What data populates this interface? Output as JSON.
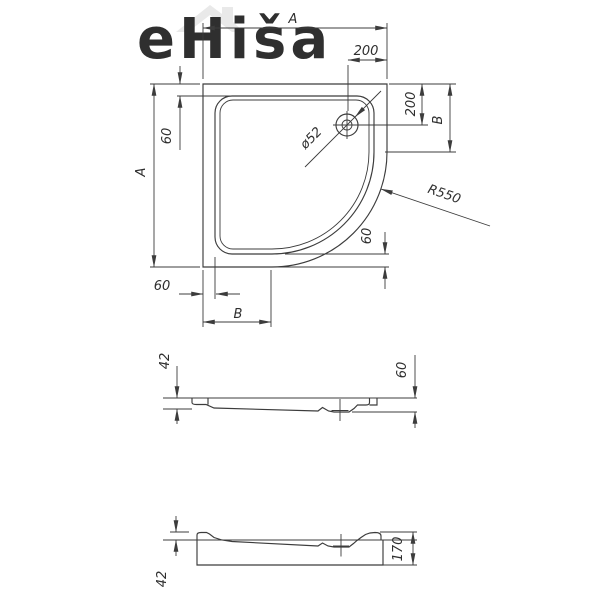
{
  "background": "#ffffff",
  "stroke_color": "#3c3c3c",
  "text_color": "#2f2f2f",
  "watermark": {
    "text": "eHiša",
    "color": "#e9e9e9",
    "icon": "house-icon"
  },
  "top_view": {
    "width_label_top": "A",
    "drain_offset_x": "200",
    "drain_offset_y": "200",
    "corner_side_label": "B",
    "rim_width_top_left": "60",
    "height_label_left": "A",
    "drain_diameter": "ø52",
    "corner_radius": "R550",
    "rim_width_curve": "60",
    "rim_width_bottom_left": "60",
    "corner_bottom_label": "B"
  },
  "section_flat": {
    "rim_height": "42",
    "total_height": "60"
  },
  "section_panel": {
    "rim_height": "42",
    "total_height": "170"
  }
}
